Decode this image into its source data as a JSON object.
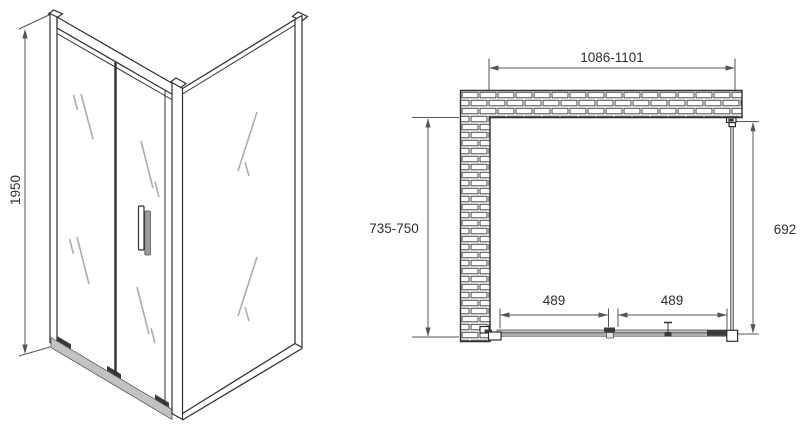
{
  "drawing": {
    "iso": {
      "height_label": "1950"
    },
    "plan": {
      "width_range_label": "1086-1101",
      "left_depth_range_label": "735-750",
      "side_panel_depth_label": "692",
      "door_segment_left_label": "489",
      "door_segment_right_label": "489"
    }
  },
  "colors": {
    "line": "#2f2f2f",
    "dim": "#555555",
    "glass-mark": "#a9adb3",
    "metal": "#c2c2c2",
    "dark-fitting": "#3a3a3a",
    "background": "#ffffff"
  }
}
